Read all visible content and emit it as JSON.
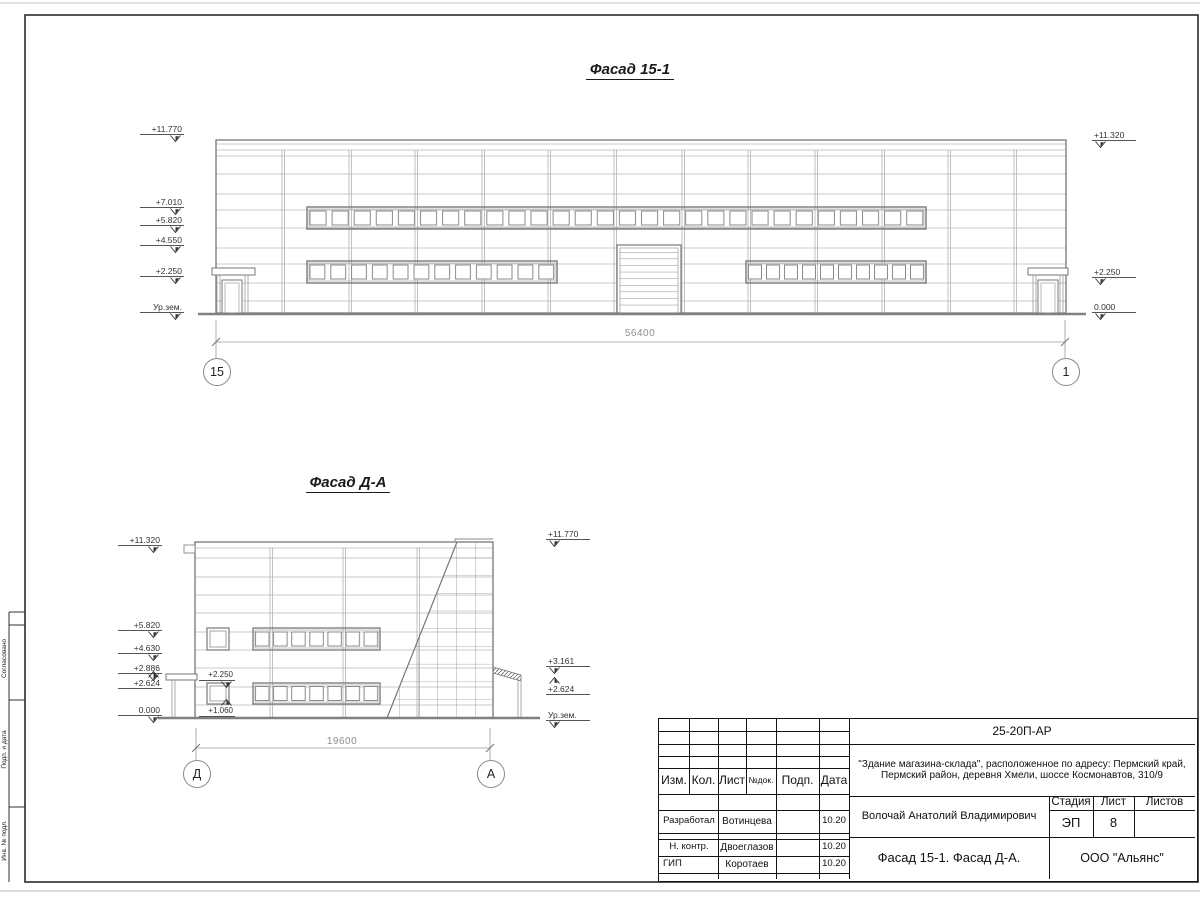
{
  "facade1": {
    "title": "Фасад 15-1",
    "marks_left": [
      "+11.770",
      "+7.010",
      "+5.820",
      "+4.550",
      "+2.250",
      "Ур.зем."
    ],
    "marks_right": [
      "+11.320",
      "+2.250",
      "0.000"
    ],
    "dimension": "56400",
    "axis_left": "15",
    "axis_right": "1"
  },
  "facade2": {
    "title": "Фасад Д-А",
    "marks_left": [
      "+11.320",
      "+5.820",
      "+4.630",
      "+2.886",
      "+2.624",
      "0.000"
    ],
    "marks_right": [
      "+11.770",
      "+3.161",
      "+2.624",
      "Ур.зем."
    ],
    "marks_inner": [
      "+2.250",
      "+1.060"
    ],
    "dimension": "19600",
    "axis_left": "Д",
    "axis_right": "А"
  },
  "titleblock": {
    "code": "25-20П-АР",
    "description_line1": "\"Здание магазина-склада\", расположенное по адресу: Пермский край,",
    "description_line2": "Пермский район, деревня Хмели, шоссе Космонавтов, 310/9",
    "rev_headers": {
      "izm": "Изм.",
      "kol": "Кол.",
      "list": "Лист",
      "ndok": "№док.",
      "podp": "Подп.",
      "data": "Дата"
    },
    "rows": [
      {
        "role": "Разработал",
        "name": "Вотинцева",
        "date": "10.20"
      },
      {
        "role": "Н. контр.",
        "name": "Двоеглазов",
        "date": "10.20"
      },
      {
        "role": "ГИП",
        "name": "Коротаев",
        "date": "10.20"
      }
    ],
    "author": "Волочай Анатолий Владимирович",
    "stage_label": "Стадия",
    "sheet_label": "Лист",
    "sheets_label": "Листов",
    "stage": "ЭП",
    "sheet_number": "8",
    "sheet_title": "Фасад 15-1. Фасад Д-А.",
    "organization": "ООО \"Альянс\""
  },
  "side_strip": {
    "labels": [
      "Согласовано",
      "Подп. и дата",
      "Инв. № подл."
    ]
  }
}
